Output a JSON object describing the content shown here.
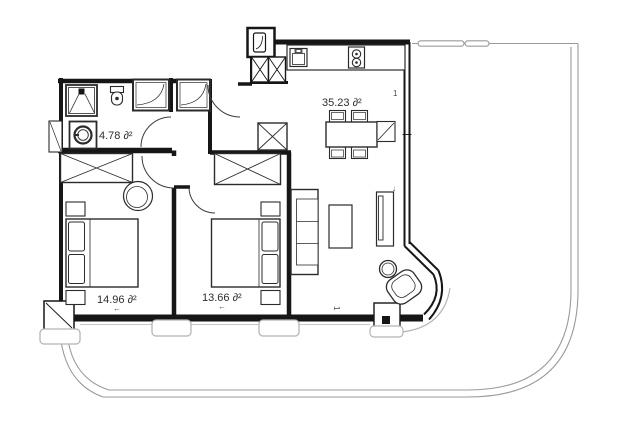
{
  "plan": {
    "type": "apartment-floor-plan",
    "colors": {
      "wall": "#161616",
      "furniture": "#2b2b2b",
      "balcony_line": "#9b9b9b",
      "window_frame": "#b5b5b5",
      "label_text": "#2e2e2e",
      "background": "#ffffff"
    },
    "rooms": [
      {
        "name": "bathroom",
        "area_label": "4.78 ∂²"
      },
      {
        "name": "kitchen-living-room",
        "area_label": "35.23 ∂²"
      },
      {
        "name": "bedroom-1",
        "area_label": "14.96 ∂²"
      },
      {
        "name": "bedroom-2",
        "area_label": "13.66 ∂²"
      }
    ],
    "marks": {
      "window_mark_right": "1",
      "window_mark_bottom": "1",
      "arrow_bedroom1": "←",
      "arrow_bedroom2": "←",
      "arrow_living": "↓"
    }
  }
}
